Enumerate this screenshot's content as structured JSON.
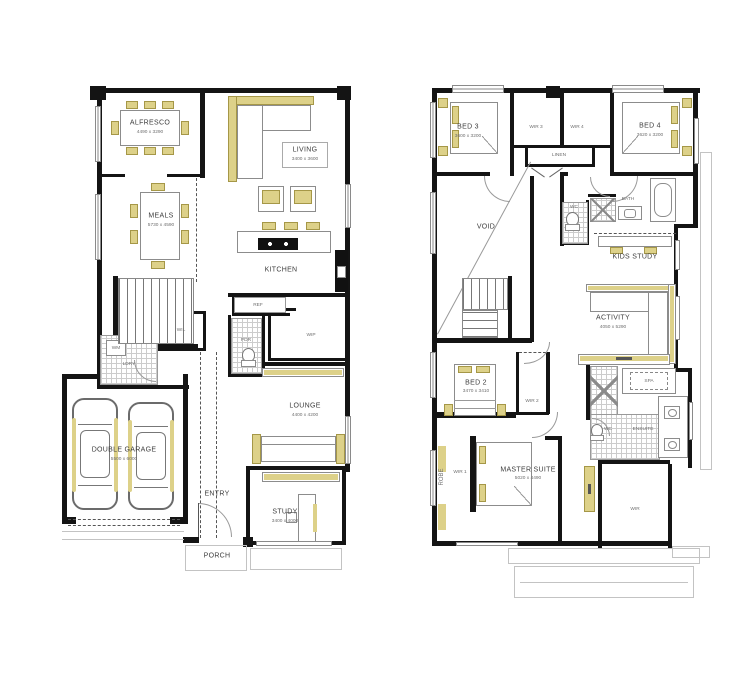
{
  "colors": {
    "wall": "#141414",
    "accent": "#ddd189",
    "label": "#3d3d3d",
    "dimension_text": "#6e6e6e"
  },
  "ground_floor": {
    "alfresco": {
      "name": "ALFRESCO",
      "dims": "4490 x 3290"
    },
    "living": {
      "name": "LIVING",
      "dims": "3400 x 3600"
    },
    "meals": {
      "name": "MEALS",
      "dims": "5730 x 4590"
    },
    "kitchen": {
      "name": "KITCHEN"
    },
    "ref": {
      "name": "REF"
    },
    "wil": {
      "name": "WIL"
    },
    "wip": {
      "name": "WIP"
    },
    "pdr": {
      "name": "PDR"
    },
    "ldry": {
      "name": "LDRY"
    },
    "wm": {
      "name": "WM"
    },
    "lounge": {
      "name": "LOUNGE",
      "dims": "4400 x 4200"
    },
    "garage": {
      "name": "DOUBLE GARAGE",
      "dims": "5500 x 6000"
    },
    "entry": {
      "name": "ENTRY"
    },
    "porch": {
      "name": "PORCH"
    },
    "study": {
      "name": "STUDY",
      "dims": "3400 x 4000"
    }
  },
  "first_floor": {
    "bed3": {
      "name": "BED 3",
      "dims": "3600 x 3200"
    },
    "wir3": {
      "name": "WIR 3"
    },
    "wir4": {
      "name": "WIR 4"
    },
    "linen": {
      "name": "LINEN"
    },
    "bed4": {
      "name": "BED 4",
      "dims": "3620 x 3200"
    },
    "bath": {
      "name": "BATH"
    },
    "wc_bath": {
      "name": "WC"
    },
    "kids_study": {
      "name": "KIDS STUDY"
    },
    "void": {
      "name": "VOID"
    },
    "activity": {
      "name": "ACTIVITY",
      "dims": "4050 x 5290"
    },
    "bed2": {
      "name": "BED 2",
      "dims": "3470 x 3410"
    },
    "wir2": {
      "name": "WIR 2"
    },
    "spa": {
      "name": "SPA"
    },
    "ensuite": {
      "name": "ENSUITE"
    },
    "wc_ensuite": {
      "name": "WC"
    },
    "master": {
      "name": "MASTER SUITE",
      "dims": "5020 x 4490"
    },
    "wir1": {
      "name": "WIR 1"
    },
    "robe": {
      "name": "ROBE"
    },
    "wir": {
      "name": "WIR"
    }
  }
}
